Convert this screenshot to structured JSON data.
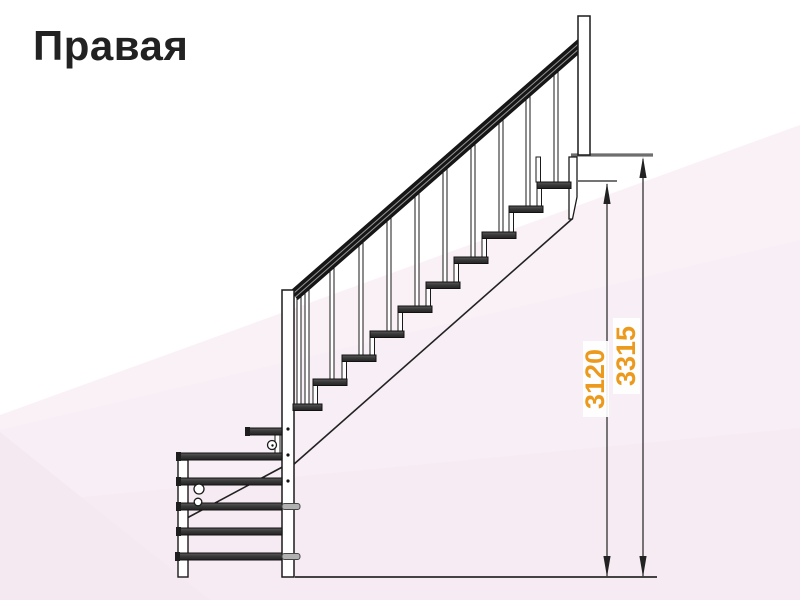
{
  "title": "Правая",
  "drawing": {
    "kind": "staircase-side-view",
    "upper_flight_tread_count": 10,
    "lower_flight_tread_count": 6
  },
  "dimensions": {
    "dim1": {
      "label": "3120"
    },
    "dim2": {
      "label": "3315"
    }
  },
  "colors": {
    "dimension_text": "#EC9A1E",
    "line": "#1a1a1a",
    "background_tint": "#f8edf4"
  }
}
